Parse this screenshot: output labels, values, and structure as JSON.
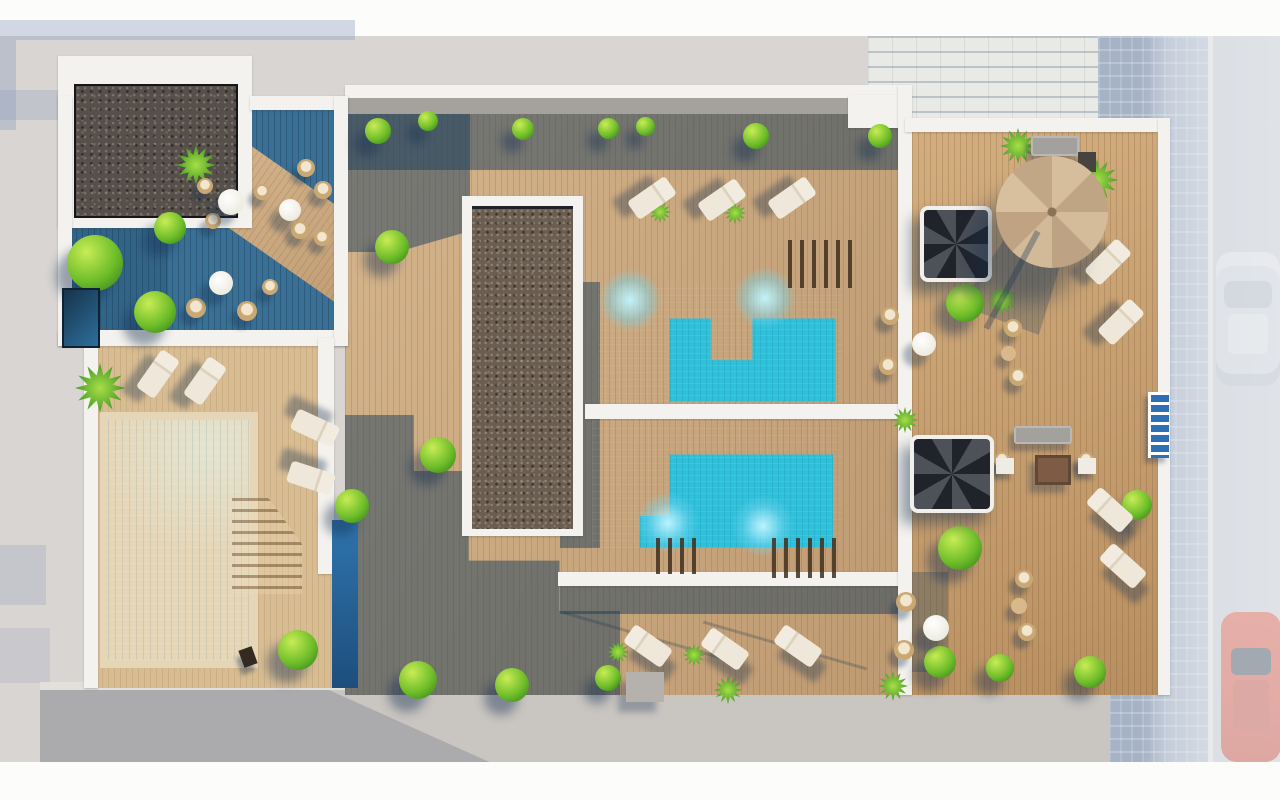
{
  "meta": {
    "description": "Top-down 3D architectural rendering of a residential rooftop terrace with swimming pools, wood decks, gravel planters, loungers, parasol, spiral stairs and a street with parked cars on the right."
  },
  "palette": {
    "bg": "#d8d5d2",
    "deck": "#c7a379",
    "deck-light": "#d8bd93",
    "deck-right": "#c59c6b",
    "teal-deck": "#3a7095",
    "shade": "rgba(28,62,92,0.5)",
    "pool-turquoise": "#2fc0da",
    "pool-left": "#3fc8db",
    "gravel": "#57504a",
    "gravel-brown": "#6b5d50",
    "wall": "#f4f2ee",
    "pavement": "#c9c5c1",
    "sidewalk": "#b7c2d2",
    "road": "#ced2d8",
    "grass": "#6fbe2a",
    "sand": "#e6d6b8",
    "car-red": "#e25844",
    "car-white": "#dee3e8",
    "umbrella": "#cdb493"
  },
  "scene": {
    "sprites": [
      {
        "t": "tree",
        "x": 95,
        "y": 263,
        "d": 56
      },
      {
        "t": "tree",
        "x": 170,
        "y": 228,
        "d": 32
      },
      {
        "t": "tree",
        "x": 155,
        "y": 312,
        "d": 42
      },
      {
        "t": "palm",
        "x": 196,
        "y": 165,
        "d": 40
      },
      {
        "t": "tree",
        "x": 378,
        "y": 131,
        "d": 26
      },
      {
        "t": "tree",
        "x": 428,
        "y": 121,
        "d": 20
      },
      {
        "t": "tree",
        "x": 523,
        "y": 129,
        "d": 22
      },
      {
        "t": "tree",
        "x": 608,
        "y": 128,
        "d": 21
      },
      {
        "t": "tree",
        "x": 645,
        "y": 126,
        "d": 19
      },
      {
        "t": "tree",
        "x": 756,
        "y": 136,
        "d": 26
      },
      {
        "t": "tree",
        "x": 880,
        "y": 136,
        "d": 24
      },
      {
        "t": "tree",
        "x": 392,
        "y": 247,
        "d": 34
      },
      {
        "t": "tree",
        "x": 438,
        "y": 455,
        "d": 36
      },
      {
        "t": "tree",
        "x": 352,
        "y": 506,
        "d": 34
      },
      {
        "t": "palm",
        "x": 100,
        "y": 388,
        "d": 50
      },
      {
        "t": "tree",
        "x": 298,
        "y": 650,
        "d": 40
      },
      {
        "t": "tree",
        "x": 418,
        "y": 680,
        "d": 38
      },
      {
        "t": "tree",
        "x": 512,
        "y": 685,
        "d": 34
      },
      {
        "t": "tree",
        "x": 608,
        "y": 678,
        "d": 26
      },
      {
        "t": "palm",
        "x": 660,
        "y": 212,
        "d": 22
      },
      {
        "t": "palm",
        "x": 735,
        "y": 213,
        "d": 22
      },
      {
        "t": "palm",
        "x": 618,
        "y": 652,
        "d": 22
      },
      {
        "t": "palm",
        "x": 694,
        "y": 655,
        "d": 22
      },
      {
        "t": "palm",
        "x": 728,
        "y": 690,
        "d": 28
      },
      {
        "t": "palm",
        "x": 893,
        "y": 686,
        "d": 30
      },
      {
        "t": "tree",
        "x": 940,
        "y": 662,
        "d": 32
      },
      {
        "t": "tree",
        "x": 1000,
        "y": 668,
        "d": 28
      },
      {
        "t": "tree",
        "x": 1090,
        "y": 672,
        "d": 32
      },
      {
        "t": "tree",
        "x": 965,
        "y": 303,
        "d": 38
      },
      {
        "t": "palm",
        "x": 1002,
        "y": 300,
        "d": 30
      },
      {
        "t": "tree",
        "x": 960,
        "y": 548,
        "d": 44
      },
      {
        "t": "palm",
        "x": 1018,
        "y": 146,
        "d": 36
      },
      {
        "t": "palm",
        "x": 1097,
        "y": 180,
        "d": 42
      },
      {
        "t": "tree",
        "x": 1137,
        "y": 505,
        "d": 30
      },
      {
        "t": "palm",
        "x": 905,
        "y": 420,
        "d": 26
      },
      {
        "t": "glow",
        "x": 630,
        "y": 300,
        "d": 62
      },
      {
        "t": "glow",
        "x": 765,
        "y": 298,
        "d": 62
      },
      {
        "t": "glow",
        "x": 668,
        "y": 523,
        "d": 62
      },
      {
        "t": "glow",
        "x": 763,
        "y": 526,
        "d": 62
      },
      {
        "t": "lounger",
        "x": 158,
        "y": 374,
        "r": 35
      },
      {
        "t": "lounger",
        "x": 205,
        "y": 381,
        "r": 35
      },
      {
        "t": "lounger",
        "x": 315,
        "y": 428,
        "r": 115
      },
      {
        "t": "lounger",
        "x": 311,
        "y": 478,
        "r": 108
      },
      {
        "t": "lounger",
        "x": 652,
        "y": 198,
        "r": 55
      },
      {
        "t": "lounger",
        "x": 722,
        "y": 200,
        "r": 55
      },
      {
        "t": "lounger",
        "x": 792,
        "y": 198,
        "r": 55
      },
      {
        "t": "lounger",
        "x": 648,
        "y": 646,
        "r": -55
      },
      {
        "t": "lounger",
        "x": 725,
        "y": 649,
        "r": -55
      },
      {
        "t": "lounger",
        "x": 798,
        "y": 646,
        "r": -55
      },
      {
        "t": "lounger",
        "x": 1108,
        "y": 262,
        "r": 45
      },
      {
        "t": "lounger",
        "x": 1121,
        "y": 322,
        "r": 45
      },
      {
        "t": "lounger",
        "x": 1110,
        "y": 510,
        "r": -48
      },
      {
        "t": "lounger",
        "x": 1123,
        "y": 566,
        "r": -48
      },
      {
        "t": "chair",
        "x": 306,
        "y": 168,
        "d": 18
      },
      {
        "t": "chair",
        "x": 323,
        "y": 190,
        "d": 18
      },
      {
        "t": "chair",
        "x": 300,
        "y": 230,
        "d": 18
      },
      {
        "t": "chair",
        "x": 322,
        "y": 238,
        "d": 16
      },
      {
        "t": "chair",
        "x": 205,
        "y": 186,
        "d": 16
      },
      {
        "t": "chair",
        "x": 213,
        "y": 221,
        "d": 16
      },
      {
        "t": "chair",
        "x": 262,
        "y": 192,
        "d": 16
      },
      {
        "t": "chair",
        "x": 196,
        "y": 308,
        "d": 20
      },
      {
        "t": "chair",
        "x": 247,
        "y": 311,
        "d": 20
      },
      {
        "t": "chair",
        "x": 270,
        "y": 287,
        "d": 16
      },
      {
        "t": "chair",
        "x": 890,
        "y": 316,
        "d": 18
      },
      {
        "t": "chair",
        "x": 888,
        "y": 366,
        "d": 18
      },
      {
        "t": "chair",
        "x": 1013,
        "y": 328,
        "d": 18
      },
      {
        "t": "chair",
        "x": 1018,
        "y": 377,
        "d": 18
      },
      {
        "t": "chair",
        "x": 906,
        "y": 602,
        "d": 20
      },
      {
        "t": "chair",
        "x": 904,
        "y": 650,
        "d": 20
      },
      {
        "t": "chair",
        "x": 1024,
        "y": 579,
        "d": 18
      },
      {
        "t": "chair",
        "x": 1027,
        "y": 632,
        "d": 18
      },
      {
        "t": "chair",
        "x": 1002,
        "y": 460,
        "d": 16
      },
      {
        "t": "chair",
        "x": 1086,
        "y": 460,
        "d": 16
      },
      {
        "t": "table-white",
        "x": 231,
        "y": 202,
        "d": 26
      },
      {
        "t": "table-white",
        "x": 290,
        "y": 210,
        "d": 22
      },
      {
        "t": "table-white",
        "x": 221,
        "y": 283,
        "d": 24
      },
      {
        "t": "table-white",
        "x": 924,
        "y": 344,
        "d": 24
      },
      {
        "t": "table-white",
        "x": 936,
        "y": 628,
        "d": 26
      },
      {
        "t": "table-tan",
        "x": 1008,
        "y": 353,
        "d": 15
      },
      {
        "t": "table-tan",
        "x": 1019,
        "y": 606,
        "d": 16
      },
      {
        "t": "sofa",
        "x": 1043,
        "y": 435,
        "w": 58,
        "h": 18
      },
      {
        "t": "sofa",
        "x": 1055,
        "y": 146,
        "w": 48,
        "h": 20
      },
      {
        "t": "table-square",
        "x": 1053,
        "y": 470,
        "w": 36,
        "h": 30
      },
      {
        "t": "side-table",
        "x": 1005,
        "y": 466,
        "w": 18,
        "h": 16
      },
      {
        "t": "side-table",
        "x": 1087,
        "y": 466,
        "w": 18,
        "h": 16
      },
      {
        "t": "dark-table",
        "x": 1087,
        "y": 162,
        "w": 18,
        "h": 20
      },
      {
        "t": "spiral-stair",
        "x": 952,
        "y": 240,
        "w": 64,
        "h": 68
      },
      {
        "t": "spiral-stair",
        "x": 948,
        "y": 470,
        "w": 76,
        "h": 70
      },
      {
        "t": "umbrella",
        "x": 1052,
        "y": 212,
        "d": 112
      },
      {
        "t": "pole-shadow",
        "x": 1012,
        "y": 280,
        "w": 6,
        "h": 110,
        "r": 28
      },
      {
        "t": "ladder",
        "x": 1157,
        "y": 425,
        "w": 18,
        "h": 66
      },
      {
        "t": "block",
        "x": 645,
        "y": 687,
        "w": 38,
        "h": 30
      },
      {
        "t": "dark-chair",
        "x": 248,
        "y": 657,
        "w": 14,
        "h": 18,
        "r": -20
      },
      {
        "t": "planter-box",
        "x": 79,
        "y": 316,
        "w": 34,
        "h": 56
      },
      {
        "t": "slats",
        "x": 820,
        "y": 264,
        "w": 64,
        "h": 48
      },
      {
        "t": "slats",
        "x": 808,
        "y": 558,
        "w": 72,
        "h": 40
      },
      {
        "t": "slats",
        "x": 678,
        "y": 556,
        "w": 44,
        "h": 36
      },
      {
        "t": "steps",
        "x": 267,
        "y": 546,
        "w": 70,
        "h": 96
      }
    ]
  }
}
